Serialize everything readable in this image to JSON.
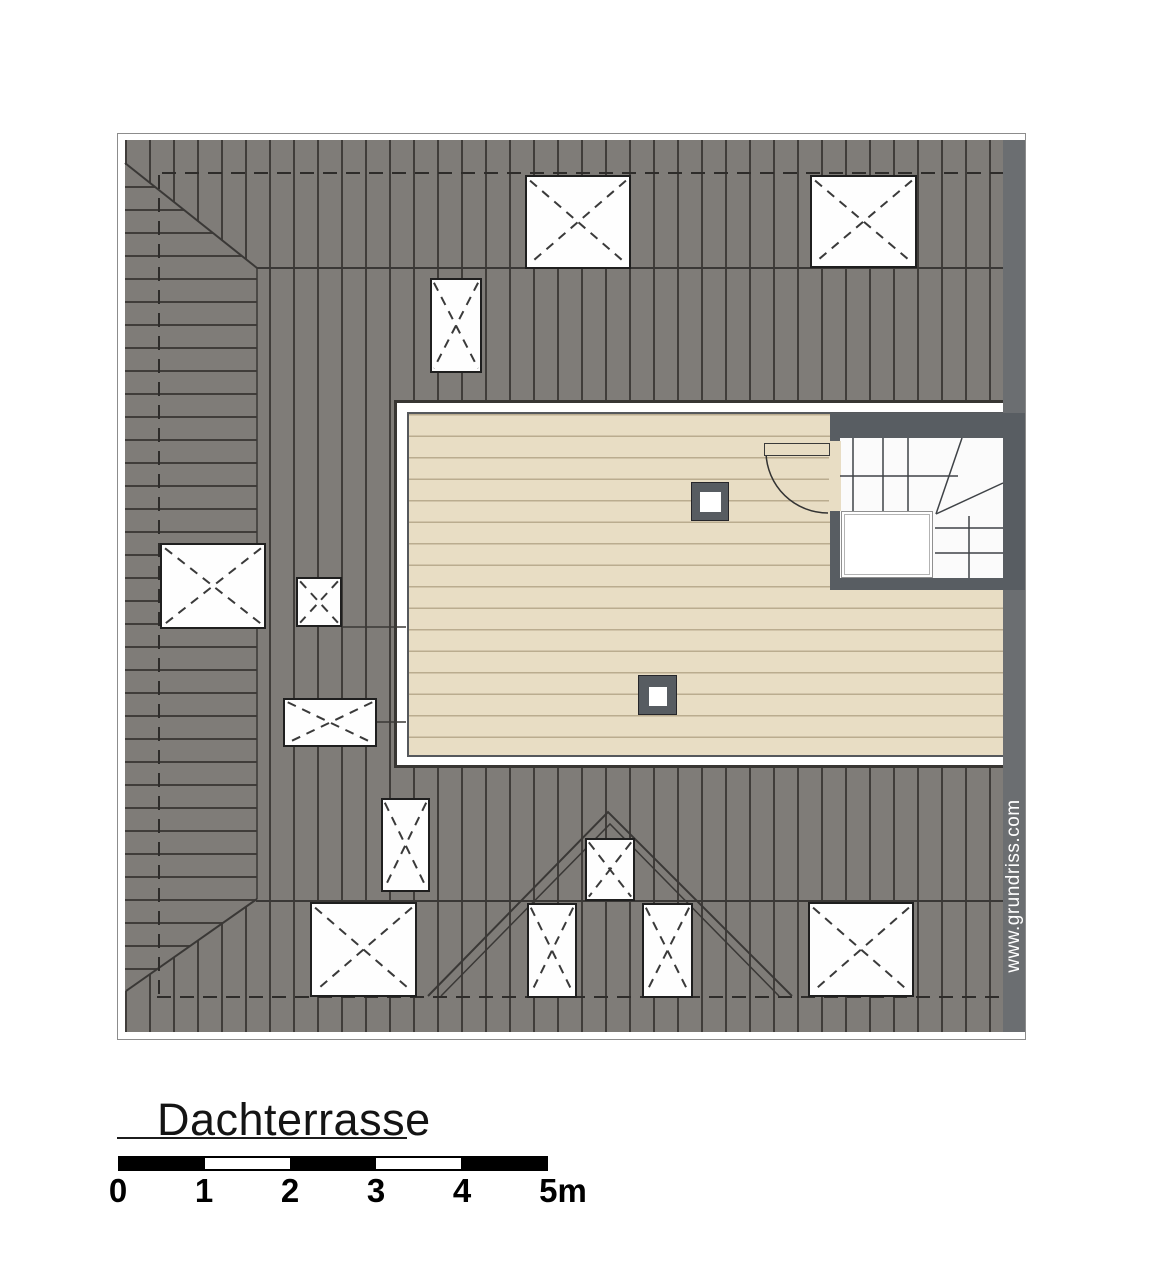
{
  "document": {
    "type": "architectural-floor-plan",
    "title": "Dachterrasse",
    "watermark": "www.grundriss.com"
  },
  "scale_bar": {
    "labels": [
      "0",
      "1",
      "2",
      "3",
      "4",
      "5m"
    ],
    "segments": 5,
    "meters_per_segment": 1
  },
  "plan_features": {
    "skylight_count": 12,
    "roof_post_count": 2,
    "has_staircase": true,
    "has_terrace_door": true,
    "dormer": "triangular gable, bottom center"
  },
  "colors": {
    "roof_gray": "#7f7c78",
    "roof_line": "#403d3a",
    "deck_beige": "#e8ddc4",
    "wall_dark_gray": "#585d62",
    "watermark_strip": "#6b6e71",
    "skylight_white": "#fefefe",
    "scale_black": "#000000"
  }
}
